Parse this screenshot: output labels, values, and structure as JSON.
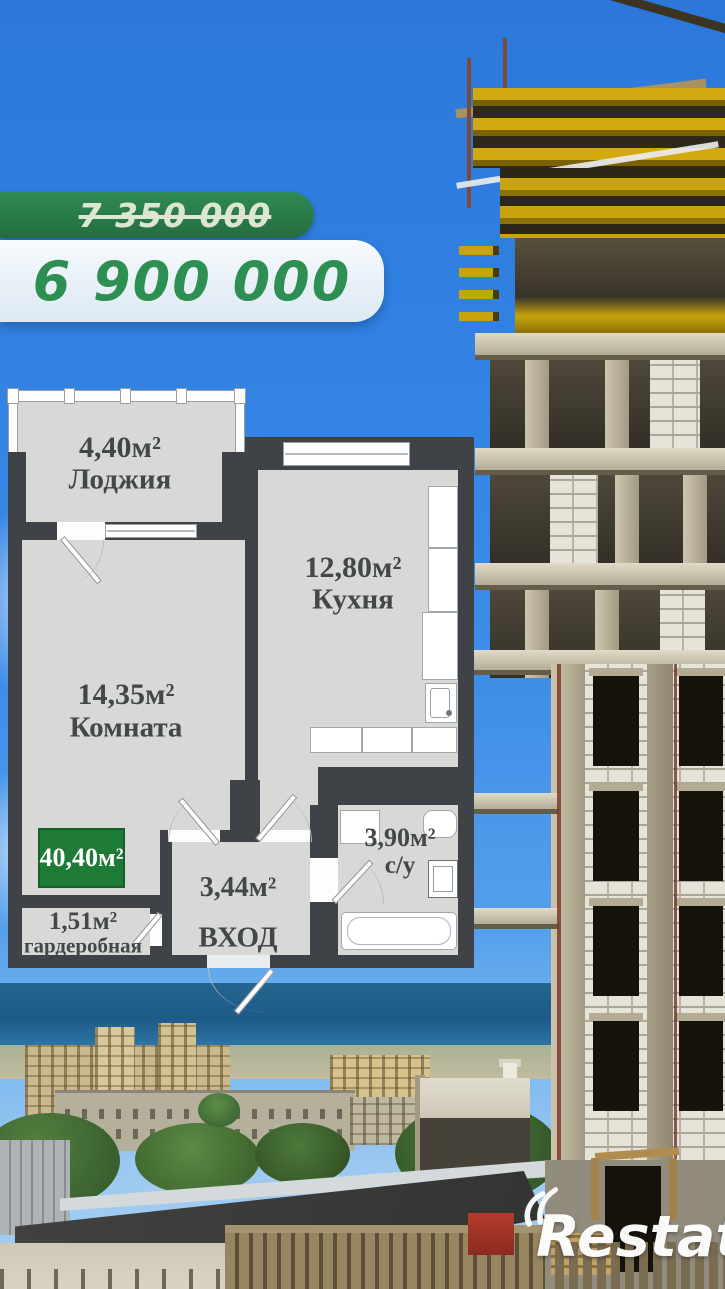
{
  "listing": {
    "old_price": "7 350 000",
    "new_price": "6 900 000"
  },
  "plan": {
    "total_area": "40,40м²",
    "loggia": {
      "area": "4,40м²",
      "name": "Лоджия"
    },
    "room": {
      "area": "14,35м²",
      "name": "Комната"
    },
    "kitchen": {
      "area": "12,80м²",
      "name": "Кухня"
    },
    "hall": {
      "area": "3,44м²",
      "name": "ВХОД"
    },
    "wardrobe": {
      "area": "1,51м²",
      "name": "гардеробная"
    },
    "bathroom": {
      "area": "3,90м²",
      "name": "с/у"
    }
  },
  "watermark": {
    "brand": "Restate"
  },
  "colors": {
    "sky": "#3282e3",
    "banner_green": "#2b7c49",
    "price_green": "#2e8f52",
    "badge_green": "#1e7b37",
    "wall_dark": "#3f4347",
    "floor_gray": "#d8d9d7"
  }
}
